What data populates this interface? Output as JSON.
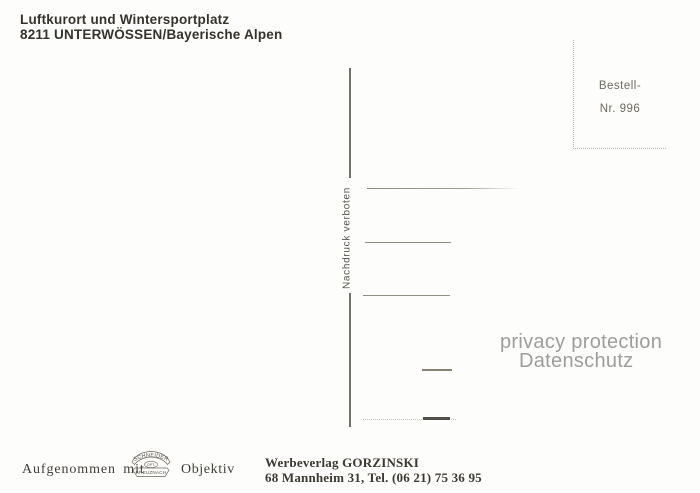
{
  "postcard": {
    "header": {
      "line1": "Luftkurort und Wintersportplatz",
      "line2": "8211 UNTERWÖSSEN/Bayerische Alpen"
    },
    "order_box": {
      "line1": "Bestell-",
      "line2": "Nr. 996"
    },
    "copyright_vertical": "Nachdruck verboten",
    "watermark": {
      "line1": "privacy protection",
      "line2": "Datenschutz"
    },
    "camera_credit": {
      "prefix": "Aufgenommen mit",
      "suffix": "Objektiv",
      "logo_top": "SCHNEIDER",
      "logo_middle": "OPT.",
      "logo_bottom": "KREUZNACH"
    },
    "publisher": {
      "line1": "Werbeverlag GORZINSKI",
      "line2": "68 Mannheim 31, Tel. (06 21) 75 36 95"
    },
    "colors": {
      "ink": "#35332b",
      "rule": "#767167",
      "watermark": "#9d9d9d",
      "background": "#fdfdfc"
    }
  }
}
